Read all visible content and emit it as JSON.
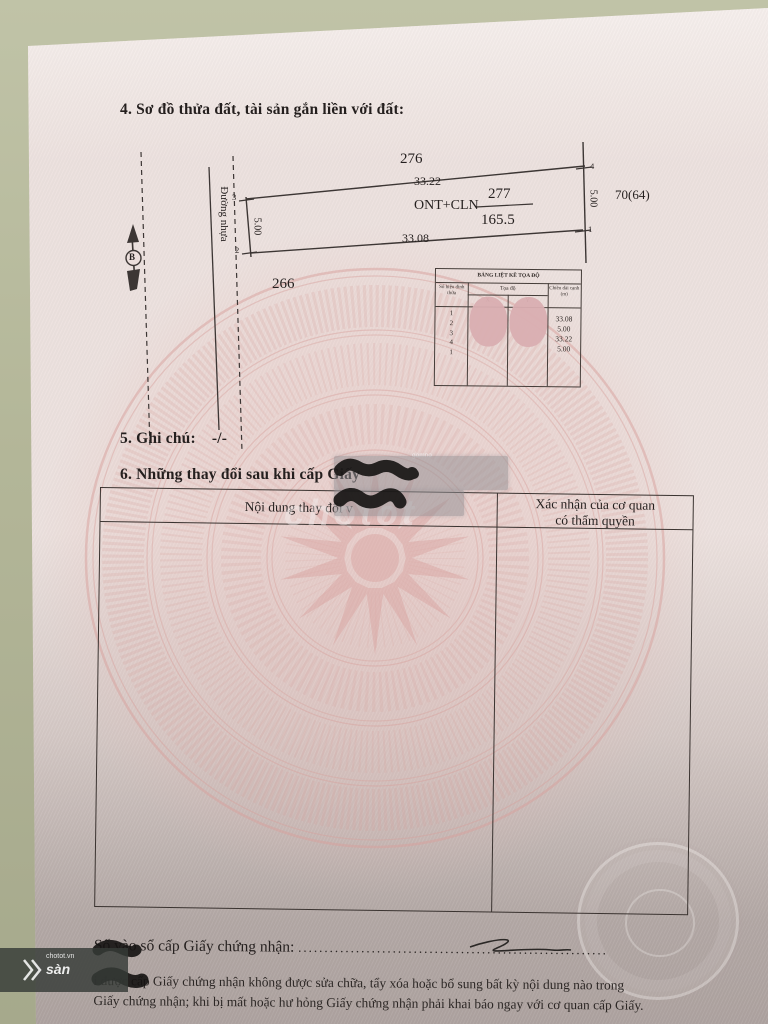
{
  "section4": {
    "heading": "4. Sơ đồ thửa đất, tài sản gắn liền với đất:"
  },
  "diagram": {
    "north_label": "B",
    "road_label": "Đường nhựa",
    "adjacent_plot_top": "276",
    "top_edge_length": "33.22",
    "plot_number": "277",
    "land_use": "ONT+CLN",
    "area": "165.5",
    "bottom_edge_length": "33.08",
    "adjacent_plot_bottom": "266",
    "right_label": "70(64)",
    "left_edge_length": "5.00",
    "right_edge_length": "5.00",
    "vertex_top_left": "3",
    "vertex_bottom_left": "2",
    "vertex_top_right": "4",
    "vertex_right": "1"
  },
  "coordinate_table": {
    "title": "BẢNG LIỆT KÊ TỌA ĐỘ",
    "col_vertex": "Số hiệu đỉnh thửa",
    "col_coords": "Tọa độ",
    "col_x": "X",
    "col_y": "Y",
    "col_length": "Chiều dài cạnh (m)",
    "vertices": [
      "1",
      "2",
      "3",
      "4",
      "1"
    ],
    "lengths": [
      "33.08",
      "5.00",
      "33.22",
      "5.00"
    ]
  },
  "section5": {
    "heading": "5. Ghi chú:",
    "value": "-/-"
  },
  "section6": {
    "heading": "6. Những thay đổi sau khi cấp Giấy",
    "col_left": "Nội dung thay đổi v",
    "col_right_line1": "Xác nhận của cơ quan",
    "col_right_line2": "có thẩm quyền"
  },
  "footer": {
    "serial_label": "Số vào sổ cấp Giấy chứng nhận:",
    "dots": "...........................................................",
    "note_line1": "i được cấp Giấy chứng nhận không được sửa chữa, tẩy xóa hoặc bổ sung bất kỳ nội dung nào trong",
    "note_line2": "Giấy chứng nhận; khi bị mất hoặc hư hỏng Giấy chứng nhận phải khai báo ngay với cơ quan cấp Giấy."
  },
  "watermarks": {
    "center": "chotot",
    "small": "gomno",
    "band_site": "chotot.vn",
    "band_text": "sàn"
  }
}
